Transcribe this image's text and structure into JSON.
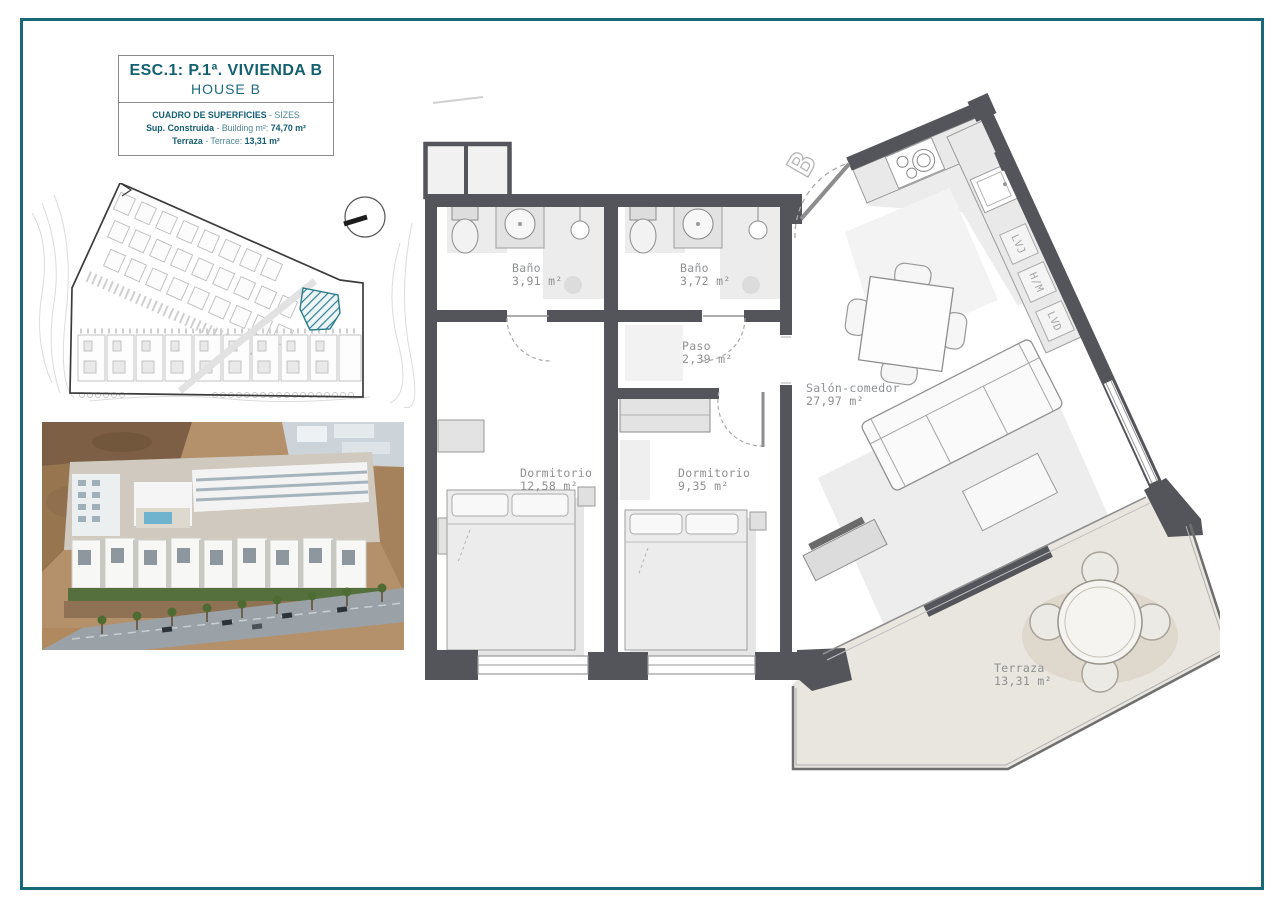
{
  "sheet": {
    "title": "ESC.1: P.1ª. VIVIENDA B",
    "subtitle": "HOUSE B",
    "sizes_table": {
      "header_bold": "CUADRO DE SUPERFICIES",
      "header_rest": " - SIZES",
      "row1_label": "Sup. Construida",
      "row1_mid": " - Building m²: ",
      "row1_value": "74,70 m²",
      "row2_label": "Terraza",
      "row2_mid": " - Terrace: ",
      "row2_value": "13,31 m²"
    }
  },
  "floor_plan": {
    "rooms": {
      "bano1": {
        "name": "Baño",
        "area": "3,91 m²"
      },
      "bano2": {
        "name": "Baño",
        "area": "3,72 m²"
      },
      "paso": {
        "name": "Paso",
        "area": "2,39 m²"
      },
      "dorm1": {
        "name": "Dormitorio",
        "area": "12,58 m²"
      },
      "dorm2": {
        "name": "Dormitorio",
        "area": "9,35 m²"
      },
      "salon": {
        "name": "Salón-comedor",
        "area": "27,97 m²"
      },
      "terraza": {
        "name": "Terraza",
        "area": "13,31 m²"
      }
    },
    "appliances": [
      "LVJ",
      "H/M",
      "LVD"
    ],
    "entrance_marker": "B"
  },
  "colors": {
    "frame_teal": "#186878",
    "title_teal": "#13606f",
    "wall_gray": "#54555a",
    "label_gray": "#8e9092",
    "terrace_fill": "#e9e5df",
    "hatch_teal": "#2d8093"
  }
}
